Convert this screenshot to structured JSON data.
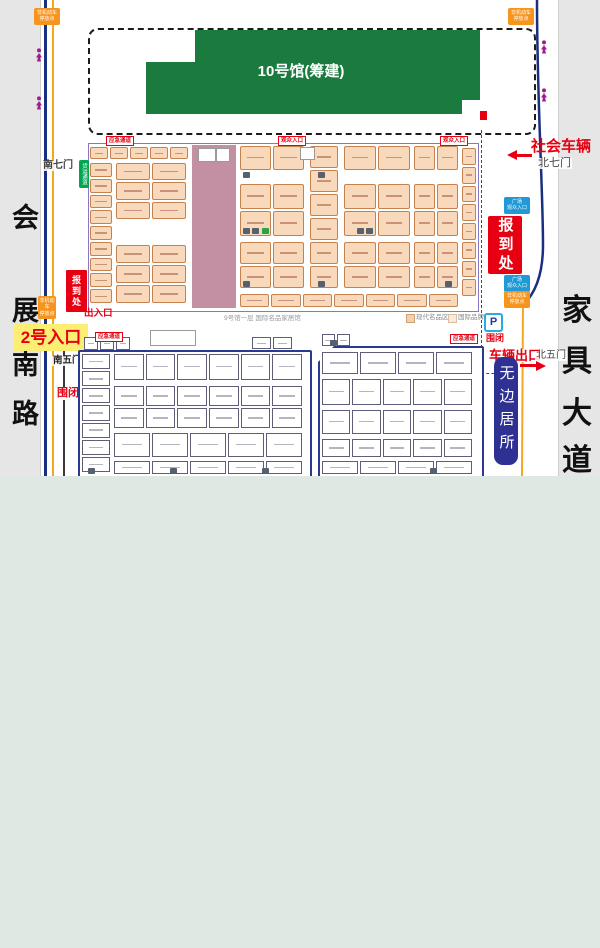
{
  "streets": {
    "left_name": "会展南路",
    "left_chars": [
      "会",
      "展",
      "南",
      "路"
    ],
    "right_name": "家具大道",
    "right_chars": [
      "家",
      "具",
      "大",
      "道"
    ]
  },
  "hall10": {
    "label": "10号馆(筹建)",
    "color": "#1b7a3e"
  },
  "gates": {
    "south7": "南七门",
    "north7": "北七门",
    "south5": "南五门",
    "north5": "北五门"
  },
  "notices": {
    "social_vehicles": "社会车辆",
    "vehicle_exit": "车辆出口",
    "entrance2": "2号入口",
    "entry_exit": "出入口",
    "registration_big": "报到处",
    "registration_small": "报到处",
    "closed_left": "围闭",
    "closed_right": "围闭",
    "parking": "P",
    "banner": "无边居所",
    "caption": "9号馆一层 国际名品家居馆"
  },
  "legend": [
    {
      "label": "现代名品区",
      "color": "#f2cfae"
    },
    {
      "label": "国际品牌区",
      "color": "#fbead8"
    }
  ],
  "red_tags": [
    {
      "text": "应急通道",
      "x": 106,
      "y": 136
    },
    {
      "text": "观众入口",
      "x": 278,
      "y": 136
    },
    {
      "text": "观众入口",
      "x": 440,
      "y": 136
    },
    {
      "text": "应急通道",
      "x": 95,
      "y": 332
    },
    {
      "text": "应急通道",
      "x": 450,
      "y": 334
    }
  ],
  "blue_tags": [
    {
      "lines": [
        "广场",
        "观众入口"
      ],
      "x": 504,
      "y": 197
    },
    {
      "lines": [
        "广场",
        "观众入口"
      ],
      "x": 504,
      "y": 275
    }
  ],
  "orange_tags": [
    {
      "lines": [
        "非机动车",
        "停放点"
      ],
      "x": 34,
      "y": 8
    },
    {
      "lines": [
        "非机动车",
        "停放点"
      ],
      "x": 508,
      "y": 8
    },
    {
      "lines": [
        "非机动车",
        "停放点"
      ],
      "x": 504,
      "y": 291,
      "w": 26
    },
    {
      "lines": [
        "非机动车",
        "停放点"
      ],
      "x": 38,
      "y": 296,
      "w": 18
    }
  ],
  "green_tag": {
    "text": "货运通道",
    "x": 79,
    "y": 160
  },
  "map": {
    "upper_zones": [
      [
        90,
        147,
        98,
        12,
        5,
        1
      ],
      [
        90,
        163,
        22,
        140,
        1,
        9
      ],
      [
        116,
        163,
        70,
        56,
        2,
        3
      ],
      [
        116,
        245,
        70,
        58,
        2,
        3
      ],
      [
        240,
        146,
        64,
        24,
        2,
        1
      ],
      [
        240,
        184,
        64,
        52,
        2,
        2
      ],
      [
        240,
        242,
        64,
        46,
        2,
        2
      ],
      [
        310,
        146,
        28,
        142,
        1,
        6
      ],
      [
        344,
        146,
        66,
        24,
        2,
        1
      ],
      [
        344,
        184,
        66,
        52,
        2,
        2
      ],
      [
        344,
        242,
        66,
        46,
        2,
        2
      ],
      [
        414,
        146,
        44,
        24,
        2,
        1
      ],
      [
        414,
        184,
        44,
        52,
        2,
        2
      ],
      [
        414,
        242,
        44,
        46,
        2,
        2
      ],
      [
        462,
        148,
        14,
        148,
        1,
        8
      ],
      [
        240,
        294,
        218,
        13,
        7,
        1
      ]
    ],
    "lower_zones": [
      [
        82,
        354,
        28,
        118,
        1,
        7
      ],
      [
        114,
        354,
        188,
        26,
        6,
        1
      ],
      [
        114,
        386,
        188,
        42,
        6,
        2
      ],
      [
        114,
        433,
        188,
        24,
        5,
        1
      ],
      [
        114,
        461,
        188,
        13,
        5,
        1
      ],
      [
        322,
        352,
        150,
        22,
        4,
        1
      ],
      [
        322,
        379,
        150,
        26,
        5,
        1
      ],
      [
        322,
        410,
        150,
        24,
        5,
        1
      ],
      [
        322,
        439,
        150,
        18,
        5,
        1
      ],
      [
        322,
        461,
        150,
        13,
        4,
        1
      ],
      [
        84,
        337,
        46,
        13,
        3,
        1
      ],
      [
        252,
        337,
        40,
        12,
        2,
        1
      ],
      [
        322,
        334,
        28,
        12,
        2,
        1
      ]
    ],
    "restroom_icons": [
      [
        243,
        172
      ],
      [
        318,
        172
      ],
      [
        243,
        228
      ],
      [
        252,
        228
      ],
      [
        357,
        228
      ],
      [
        366,
        228
      ],
      [
        243,
        281
      ],
      [
        318,
        281
      ],
      [
        445,
        281
      ],
      [
        88,
        468
      ],
      [
        170,
        468
      ],
      [
        262,
        468
      ],
      [
        430,
        468
      ],
      [
        330,
        340
      ]
    ],
    "green_icons": [
      [
        262,
        228
      ]
    ],
    "stair_icons": [
      [
        198,
        148,
        16,
        12
      ],
      [
        216,
        148,
        12,
        12
      ],
      [
        300,
        147,
        13,
        11
      ],
      [
        150,
        330,
        44,
        14
      ]
    ],
    "pedestrian_icons": [
      [
        34,
        48
      ],
      [
        34,
        96
      ],
      [
        539,
        40
      ],
      [
        539,
        88
      ]
    ]
  }
}
